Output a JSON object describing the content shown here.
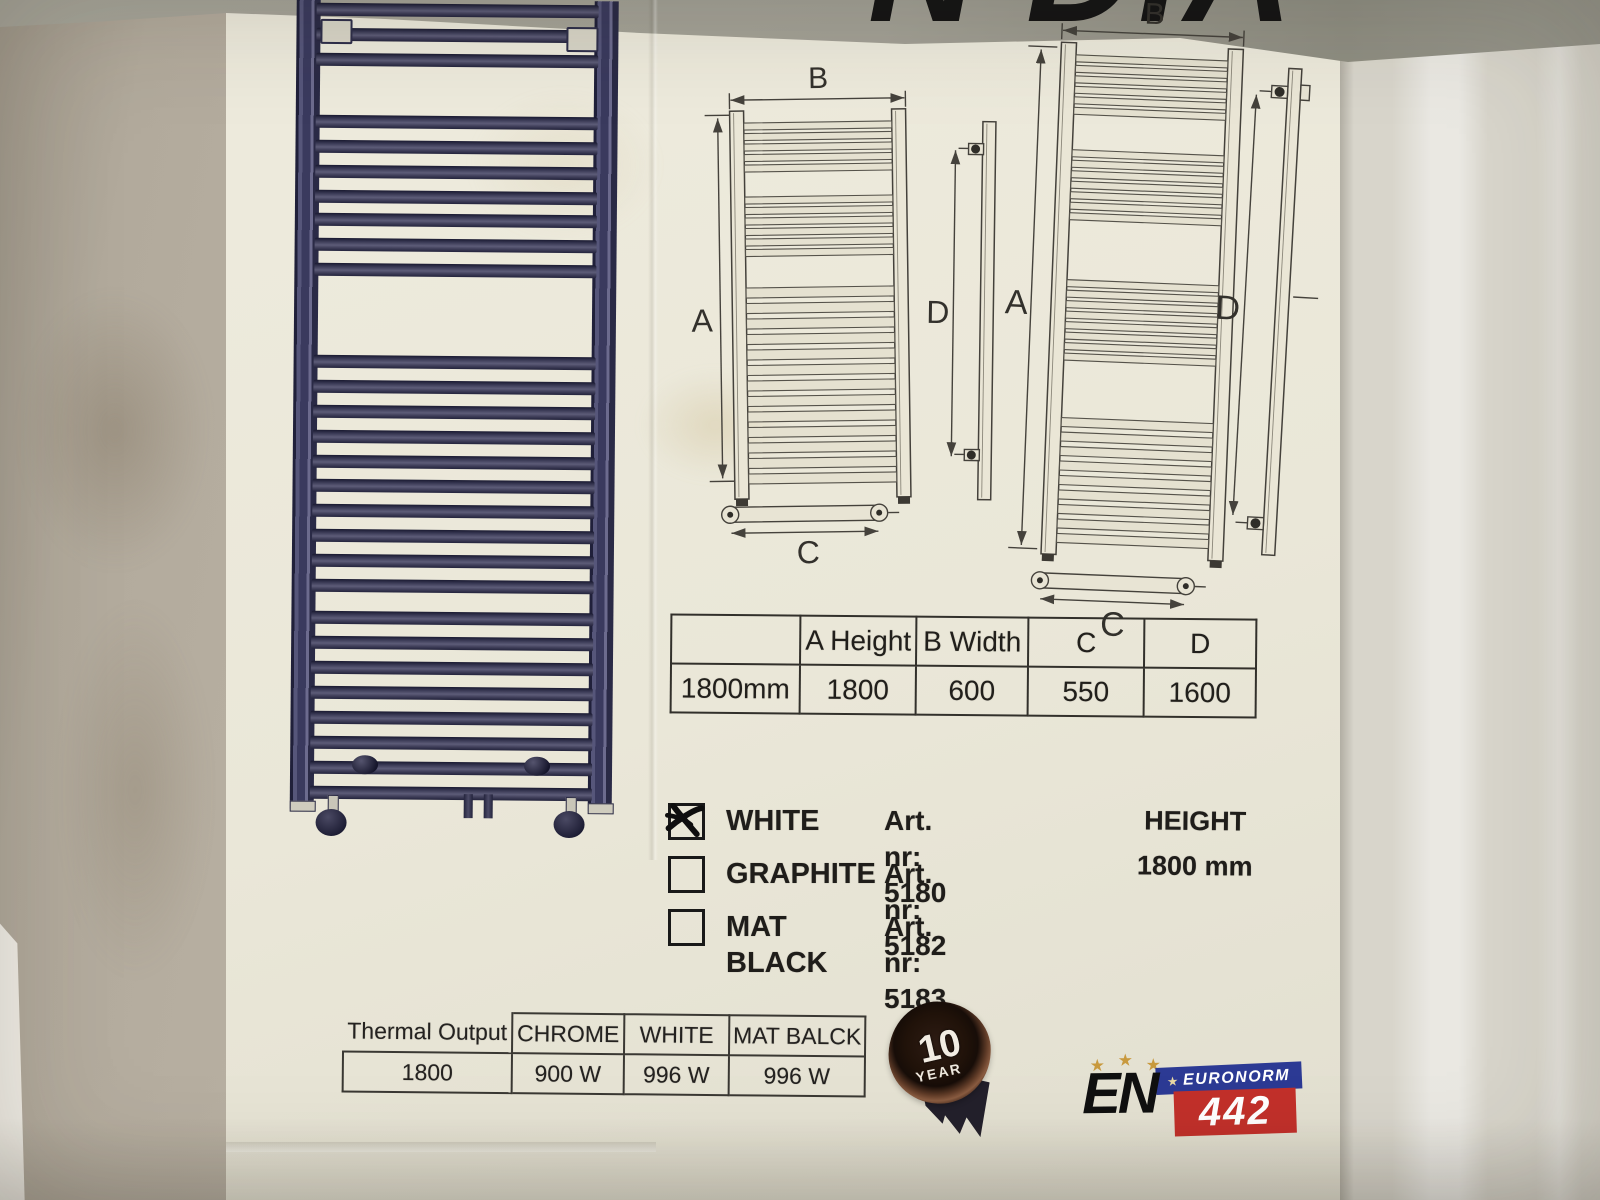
{
  "scene": {
    "brand_fragment": "N DIA",
    "wall_hex": "#b2aa9c",
    "box_hex": "#eae7d8",
    "band_hex": "#a3a196",
    "side_hex": "#d8d5cb"
  },
  "radiator_art": {
    "color_hex": "#3a3a5e",
    "pitch": 25,
    "bar_groups": [
      {
        "y": 4,
        "count": 3
      },
      {
        "y": 116,
        "count": 4
      },
      {
        "y": 214,
        "count": 3
      },
      {
        "y": 356,
        "count": 5
      },
      {
        "y": 480,
        "count": 5
      },
      {
        "y": 612,
        "count": 8
      }
    ]
  },
  "diagrams": {
    "labels": {
      "a": "A",
      "b": "B",
      "c": "C",
      "d": "D"
    },
    "small": {
      "bar_groups": [
        {
          "y": 122,
          "count": 5,
          "pitch": 10.5,
          "h": 7
        },
        {
          "y": 196,
          "count": 6,
          "pitch": 10.5,
          "h": 7
        },
        {
          "y": 287,
          "count": 13,
          "pitch": 15.5,
          "h": 10
        }
      ]
    },
    "large": {
      "bar_groups": [
        {
          "y": 57,
          "count": 6,
          "pitch": 10.5,
          "h": 7
        },
        {
          "y": 152,
          "count": 7,
          "pitch": 10.5,
          "h": 7
        },
        {
          "y": 282,
          "count": 8,
          "pitch": 10.5,
          "h": 7
        },
        {
          "y": 420,
          "count": 9,
          "pitch": 14.5,
          "h": 9
        }
      ]
    }
  },
  "dimensions_table": {
    "headers": [
      "",
      "A Height",
      "B Width",
      "C",
      "D"
    ],
    "rows": [
      [
        "1800mm",
        "1800",
        "600",
        "550",
        "1600"
      ]
    ]
  },
  "options": {
    "items": [
      {
        "label": "WHITE",
        "art": "Art. nr: 5180",
        "checked": true
      },
      {
        "label": "GRAPHITE",
        "art": "Art. nr: 5182",
        "checked": false
      },
      {
        "label": "MAT BLACK",
        "art": "Art. nr: 5183",
        "checked": false
      }
    ],
    "height_label": "HEIGHT",
    "height_value": "1800 mm"
  },
  "thermal_table": {
    "headers": [
      "Thermal Output",
      "CHROME",
      "WHITE",
      "MAT BALCK"
    ],
    "rows": [
      [
        "1800",
        "900 W",
        "996 W",
        "996 W"
      ]
    ]
  },
  "badge": {
    "value": "10",
    "unit": "YEAR"
  },
  "certification": {
    "en": "EN",
    "euronorm": "EURONORM",
    "number": "442",
    "blue_hex": "#2c3a94",
    "red_hex": "#c2302a",
    "star_hex": "#c8993d"
  }
}
